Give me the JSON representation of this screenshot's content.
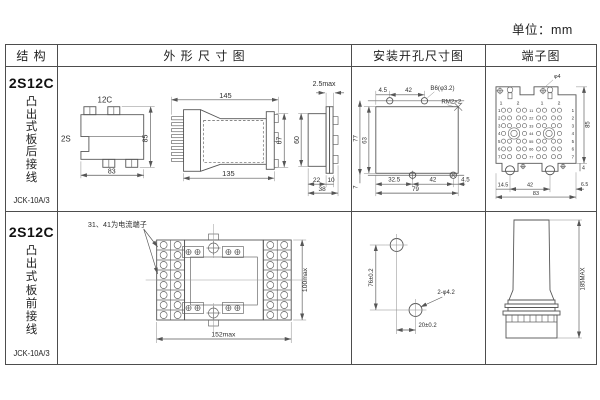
{
  "page": {
    "unit_label": "单位：mm"
  },
  "table": {
    "header": {
      "structure": "结 构",
      "outline": "外 形 尺 寸 图",
      "mounting": "安装开孔尺寸图",
      "terminal": "端子图"
    }
  },
  "row1": {
    "model": "2S12C",
    "mount_text": "凸出式板后接线",
    "code": "JCK-10A/3",
    "top_view": {
      "label_top": "12C",
      "label_left": "2S",
      "dim_h": "85",
      "dim_w": "83"
    },
    "side_view": {
      "dim_total": "145",
      "dim_body": "135",
      "dim_h": "67"
    },
    "end_view": {
      "dim_flange": "2.5max",
      "dim_h": "60",
      "dim_a": "22",
      "dim_b": "10",
      "dim_w": "38"
    },
    "mounting": {
      "dim_t1": "4.5",
      "dim_t2": "42",
      "hole_label": "B6(φ3.2)",
      "screw_label": "RM2×2",
      "dim_v1": "77",
      "dim_v2": "63",
      "dim_v3": "7",
      "dim_b1": "32.5",
      "dim_b2": "42",
      "dim_b3": "4.5",
      "dim_total": "79"
    },
    "terminal": {
      "hole_label": "φ4",
      "post_labels": [
        "1",
        "2",
        "1",
        "2"
      ],
      "row_numbers": [
        "1",
        "2",
        "3",
        "4",
        "5",
        "6",
        "7"
      ],
      "center_numbers": [
        "11",
        "22",
        "33",
        "44",
        "55",
        "66",
        "77"
      ],
      "dim_b1": "14.5",
      "dim_b2": "42",
      "dim_total": "83",
      "dim_h": "85",
      "dim_r1": "4",
      "dim_r2": "6.5"
    }
  },
  "row2": {
    "model": "2S12C",
    "mount_text": "凸出式板前接线",
    "code": "JCK-10A/3",
    "front_view": {
      "note": "31、41为电流端子",
      "dim_w": "152max",
      "dim_h": "100max"
    },
    "mounting": {
      "dim_v": "76±0.2",
      "dim_h": "20±0.2",
      "hole_label": "2-φ4.2"
    },
    "side_view": {
      "dim_h": "185MAX"
    }
  }
}
